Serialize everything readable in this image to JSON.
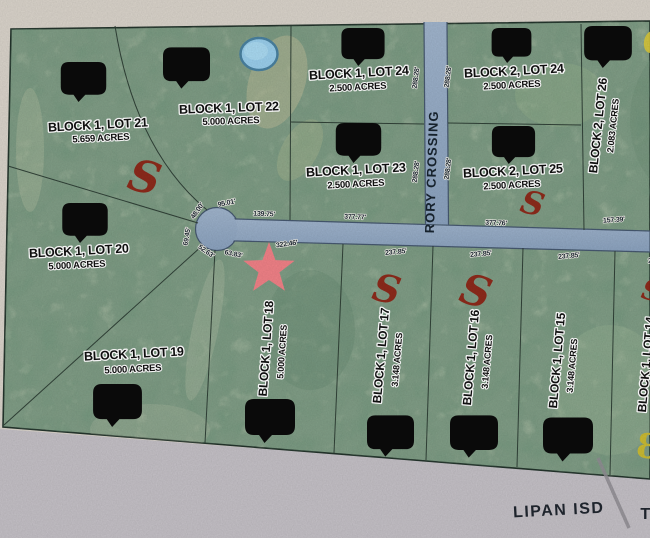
{
  "map": {
    "road_name": "RORY CROSSING",
    "district_left": "LIPAN ISD",
    "district_right": "T",
    "lots": [
      {
        "name": "BLOCK 1, LOT 21",
        "acres": "5.659 ACRES"
      },
      {
        "name": "BLOCK 1, LOT 22",
        "acres": "5.000 ACRES"
      },
      {
        "name": "BLOCK 1, LOT 24",
        "acres": "2.500 ACRES"
      },
      {
        "name": "BLOCK 1, LOT 23",
        "acres": "2.500 ACRES"
      },
      {
        "name": "BLOCK 2, LOT 24",
        "acres": "2.500 ACRES"
      },
      {
        "name": "BLOCK 2, LOT 25",
        "acres": "2.500 ACRES"
      },
      {
        "name": "BLOCK 2, LOT 26",
        "acres": "2.083 ACRES"
      },
      {
        "name": "BLOCK 1, LOT 20",
        "acres": "5.000 ACRES"
      },
      {
        "name": "BLOCK 1, LOT 19",
        "acres": "5.000 ACRES"
      },
      {
        "name": "BLOCK 1, LOT 18",
        "acres": "5.000 ACRES"
      },
      {
        "name": "BLOCK 1, LOT 17",
        "acres": "3.148 ACRES"
      },
      {
        "name": "BLOCK 1, LOT 16",
        "acres": "3.148 ACRES"
      },
      {
        "name": "BLOCK 1, LOT 15",
        "acres": "3.148 ACRES"
      },
      {
        "name": "BLOCK 1, LOT 14",
        "acres": ""
      }
    ],
    "measurements": {
      "cul_95": "95.01'",
      "cul_48": "48.00'",
      "cul_69": "69.45'",
      "cul_52": "52.63'",
      "cul_63": "63.83'",
      "seg_139": "139.75'",
      "seg_322": "322.46'",
      "seg_377a": "377.77'",
      "seg_377b": "377.76'",
      "seg_157": "157.39'",
      "rory_side": "288.28'",
      "bottom_row": "237.85'"
    },
    "annotations": {
      "s_mark": "S",
      "eight_mark": "8"
    },
    "colors": {
      "lot_green": "#7f9c85",
      "road_blue": "#93aac5",
      "paper_beige": "#d8d2c9",
      "paper_gray": "#c3bfc5",
      "marker_black": "#0b0b0b",
      "s_mark_red": "#8e2113",
      "star_pink": "#ef8086",
      "pond_blue": "#99cdea",
      "highlight_yellow": "#cdbb2e"
    }
  }
}
